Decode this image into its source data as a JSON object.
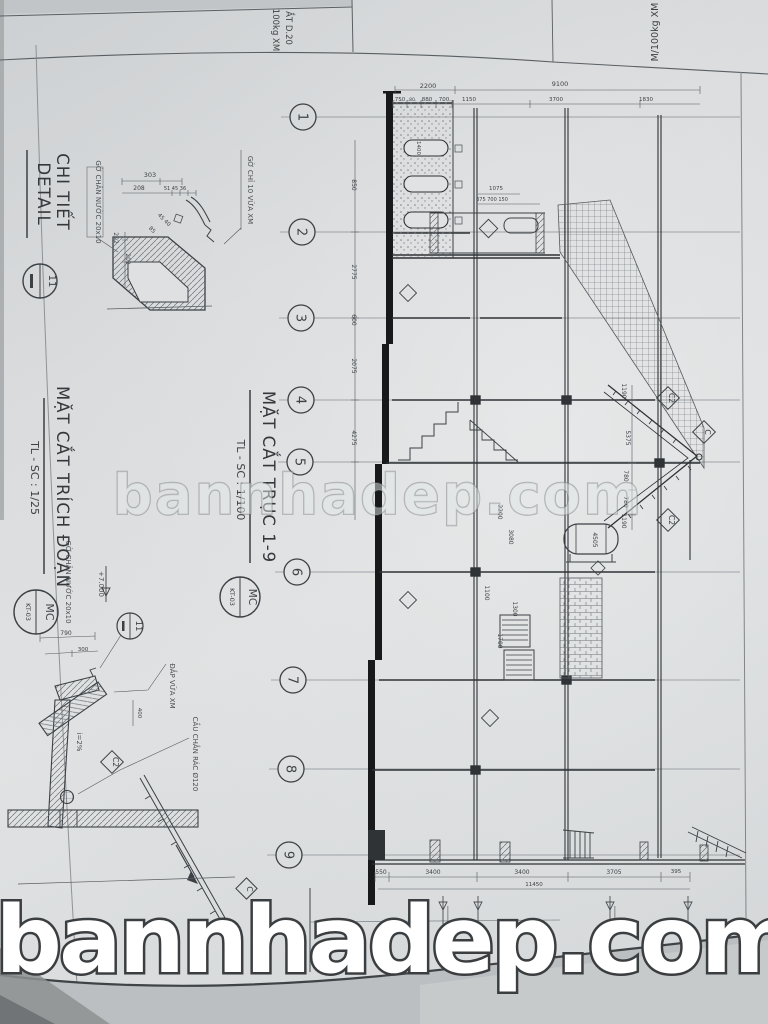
{
  "photo": {
    "center_watermark": "bannhadep.com",
    "bottom_watermark": "bannhadep.com"
  },
  "adjacent_sheet": {
    "col1_line1": "ẮT D.20",
    "col1_line2": "100kg XM",
    "col2": "M/100kg XM"
  },
  "detail_view": {
    "title_line1": "CHI TIẾT",
    "title_line2": "DETAIL",
    "bubble_number": "11",
    "label_water_drip": "GỜ CHÂN NƯỚC 20x10",
    "label_mortar_trim": "GỜ CHỈ 10 VỮA XM"
  },
  "excerpt_view": {
    "title": "MẶT CẮT TRÍCH ĐOẠN",
    "scale": "TL - SC : 1/25",
    "ref_bubble_top": "MC",
    "ref_bubble_bottom": "KT-03",
    "detail_bubble": "11",
    "level_mark": "+7.000",
    "label_water_drip": "GỜ CHÂN NƯỚC 20x10",
    "label_mortar": "ĐẮP VỮA XM",
    "label_gravel_guard": "CẦU CHẮN RÁC Ø120",
    "slope": "i=2%",
    "tag_c2": "C2",
    "tag_c": "C"
  },
  "main_view": {
    "title": "MẶT CẮT TRỤC 1-9",
    "scale": "TL - SC : 1/100",
    "ref_bubble_top": "MC",
    "ref_bubble_bottom": "KT-03",
    "roof_tag_upper": "C2",
    "roof_tag_mid": "C",
    "roof_tag_lower": "C2",
    "grid": [
      {
        "n": "1",
        "x": 303,
        "y": 117
      },
      {
        "n": "2",
        "x": 302,
        "y": 232
      },
      {
        "n": "3",
        "x": 301,
        "y": 318
      },
      {
        "n": "4",
        "x": 301,
        "y": 400
      },
      {
        "n": "5",
        "x": 300,
        "y": 462
      },
      {
        "n": "6",
        "x": 297,
        "y": 572
      },
      {
        "n": "7",
        "x": 293,
        "y": 680
      },
      {
        "n": "8",
        "x": 291,
        "y": 769
      },
      {
        "n": "9",
        "x": 289,
        "y": 855
      }
    ]
  },
  "annotations": [
    {
      "t": "2200",
      "x": 428,
      "y": 88,
      "r": 0,
      "s": 6.5
    },
    {
      "t": "9100",
      "x": 560,
      "y": 86,
      "r": 0,
      "s": 6.5
    },
    {
      "t": "750",
      "x": 400,
      "y": 101,
      "r": 0,
      "s": 5.5
    },
    {
      "t": "80",
      "x": 412,
      "y": 101,
      "r": 0,
      "s": 4.5
    },
    {
      "t": "880",
      "x": 427,
      "y": 101,
      "r": 0,
      "s": 5.5
    },
    {
      "t": "700",
      "x": 444,
      "y": 101,
      "r": 0,
      "s": 5.5
    },
    {
      "t": "1150",
      "x": 469,
      "y": 101,
      "r": 0,
      "s": 5.5
    },
    {
      "t": "3700",
      "x": 556,
      "y": 101,
      "r": 0,
      "s": 5.5
    },
    {
      "t": "1830",
      "x": 646,
      "y": 101,
      "r": 0,
      "s": 5.5
    },
    {
      "t": "550",
      "x": 381,
      "y": 874,
      "r": 0,
      "s": 6
    },
    {
      "t": "3400",
      "x": 433,
      "y": 874,
      "r": 0,
      "s": 6
    },
    {
      "t": "3400",
      "x": 522,
      "y": 874,
      "r": 0,
      "s": 6
    },
    {
      "t": "3705",
      "x": 614,
      "y": 874,
      "r": 0,
      "s": 6
    },
    {
      "t": "395",
      "x": 676,
      "y": 873,
      "r": 0,
      "s": 5.5
    },
    {
      "t": "11450",
      "x": 534,
      "y": 886,
      "r": 0,
      "s": 5.5
    },
    {
      "t": "850",
      "x": 352,
      "y": 185,
      "r": 90,
      "s": 6
    },
    {
      "t": "2775",
      "x": 352,
      "y": 272,
      "r": 90,
      "s": 6
    },
    {
      "t": "600",
      "x": 352,
      "y": 320,
      "r": 90,
      "s": 6
    },
    {
      "t": "2075",
      "x": 352,
      "y": 366,
      "r": 90,
      "s": 6
    },
    {
      "t": "4275",
      "x": 352,
      "y": 438,
      "r": 90,
      "s": 6
    },
    {
      "t": "1190",
      "x": 622,
      "y": 391,
      "r": 90,
      "s": 6
    },
    {
      "t": "5375",
      "x": 626,
      "y": 438,
      "r": 90,
      "s": 6
    },
    {
      "t": "780",
      "x": 624,
      "y": 476,
      "r": 90,
      "s": 6
    },
    {
      "t": "780",
      "x": 624,
      "y": 502,
      "r": 90,
      "s": 6
    },
    {
      "t": "1190",
      "x": 622,
      "y": 521,
      "r": 90,
      "s": 6
    },
    {
      "t": "4505",
      "x": 593,
      "y": 540,
      "r": 90,
      "s": 6
    },
    {
      "t": "1400",
      "x": 417,
      "y": 148,
      "r": 90,
      "s": 5.5
    },
    {
      "t": "1075",
      "x": 496,
      "y": 190,
      "r": 0,
      "s": 5.5
    },
    {
      "t": "375 700 150",
      "x": 492,
      "y": 201,
      "r": 0,
      "s": 5
    },
    {
      "t": "2200",
      "x": 498,
      "y": 512,
      "r": 90,
      "s": 6
    },
    {
      "t": "3080",
      "x": 509,
      "y": 537,
      "r": 90,
      "s": 6
    },
    {
      "t": "1100",
      "x": 485,
      "y": 593,
      "r": 90,
      "s": 6
    },
    {
      "t": "1300",
      "x": 513,
      "y": 609,
      "r": 90,
      "s": 6
    },
    {
      "t": "1700",
      "x": 498,
      "y": 641,
      "r": 90,
      "s": 6
    },
    {
      "t": "303",
      "x": 150,
      "y": 177,
      "r": 0,
      "s": 6.5
    },
    {
      "t": "208",
      "x": 139,
      "y": 190,
      "r": 0,
      "s": 6
    },
    {
      "t": "51 45 36",
      "x": 175,
      "y": 190,
      "r": 0,
      "s": 5
    },
    {
      "t": "45 40",
      "x": 163,
      "y": 221,
      "r": 45,
      "s": 5.5
    },
    {
      "t": "85",
      "x": 151,
      "y": 231,
      "r": 45,
      "s": 5.5
    },
    {
      "t": "202",
      "x": 126,
      "y": 259,
      "r": 90,
      "s": 6
    },
    {
      "t": "202",
      "x": 114,
      "y": 238,
      "r": 90,
      "s": 6
    },
    {
      "t": "790",
      "x": 66,
      "y": 635,
      "r": 0,
      "s": 6
    },
    {
      "t": "300",
      "x": 83,
      "y": 651,
      "r": 0,
      "s": 5.5
    },
    {
      "t": "400",
      "x": 138,
      "y": 713,
      "r": 90,
      "s": 5.5
    }
  ]
}
